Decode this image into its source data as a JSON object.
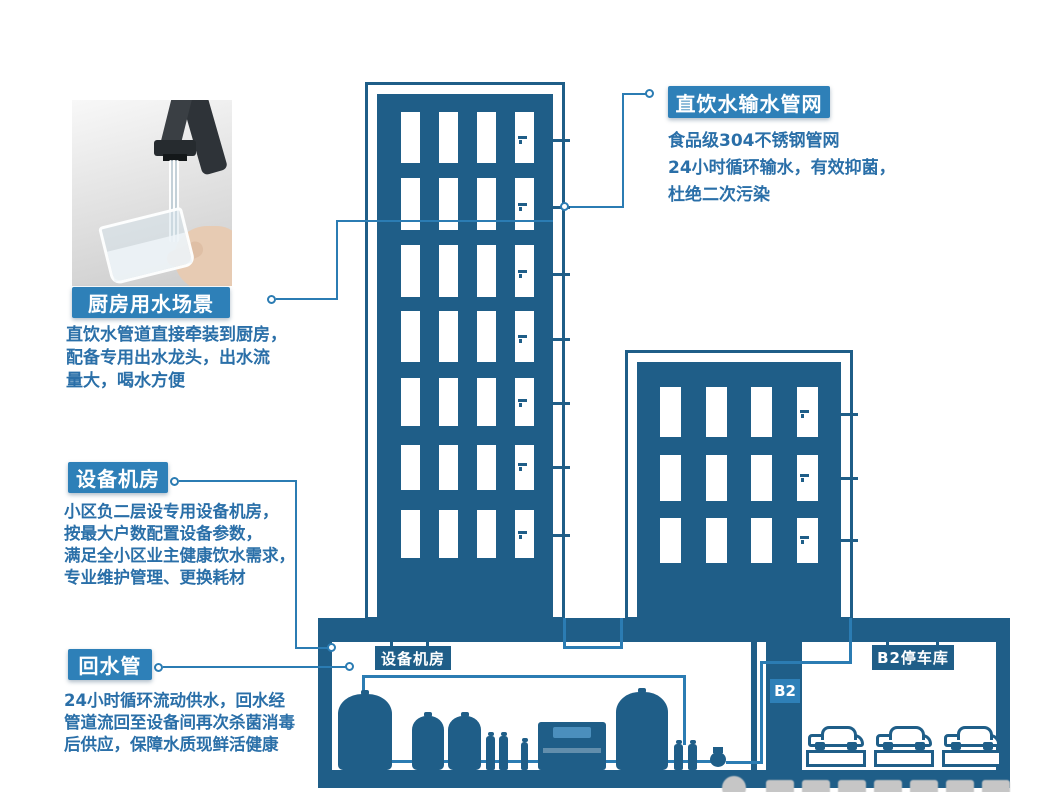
{
  "palette": {
    "dark_blue": "#1f5e88",
    "badge_blue": "#2e80b8",
    "pipe_blue": "#2b7cb3",
    "text_blue": "#2a6fa8"
  },
  "callouts": {
    "supply_network": {
      "title": "直饮水输水管网",
      "desc": [
        "食品级304不锈钢管网",
        "24小时循环输水，有效抑菌，",
        "杜绝二次污染"
      ]
    },
    "kitchen": {
      "title": "厨房用水场景",
      "desc": [
        "直饮水管道直接牵装到厨房，",
        "配备专用出水龙头，出水流",
        "量大，喝水方便"
      ]
    },
    "equipment_room": {
      "title": "设备机房",
      "desc": [
        "小区负二层设专用设备机房，",
        "按最大户数配置设备参数，",
        "满足全小区业主健康饮水需求，",
        "专业维护管理、更换耗材"
      ]
    },
    "return_pipe": {
      "title": "回水管",
      "desc": [
        "24小时循环流动供水，回水经",
        "管道流回至设备间再次杀菌消毒",
        "后供应，保障水质现鲜活健康"
      ]
    }
  },
  "basement": {
    "equipment_room_sign": "设备机房",
    "elevator_badge": "B2",
    "parking_sign": "B2停车库"
  }
}
